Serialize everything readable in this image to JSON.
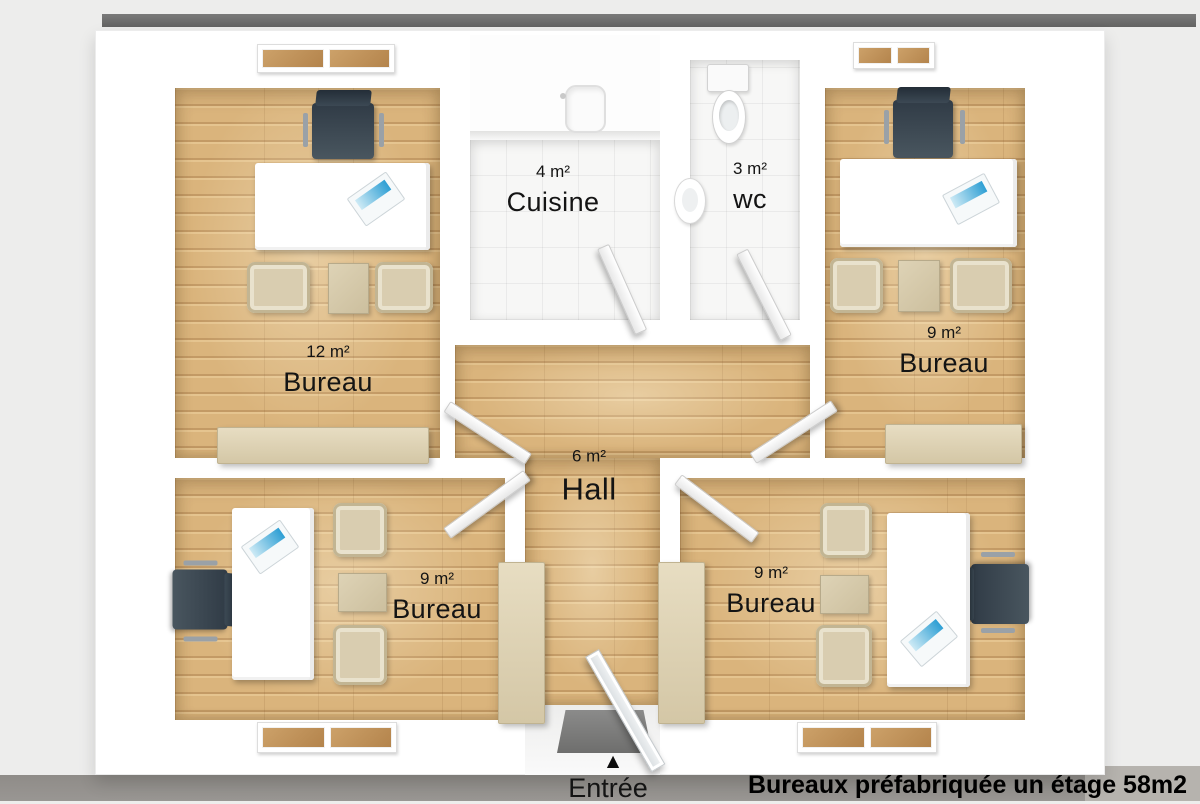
{
  "floorplan": {
    "caption": "Bureaux préfabriquée un étage 58m2",
    "entrance": {
      "label": "Entrée",
      "arrow": "▲"
    },
    "rooms": [
      {
        "name": "Bureau",
        "area": "12 m²"
      },
      {
        "name": "Cuisine",
        "area": "4 m²"
      },
      {
        "name": "wc",
        "area": "3 m²"
      },
      {
        "name": "Bureau",
        "area": "9 m²"
      },
      {
        "name": "Hall",
        "area": "6 m²"
      },
      {
        "name": "Bureau",
        "area": "9 m²"
      },
      {
        "name": "Bureau",
        "area": "9 m²"
      }
    ],
    "colors": {
      "wood": "#d9b57f",
      "wall": "#ffffff",
      "tile": "#f7f7f6",
      "office_chair": "#3c4854",
      "upholstery": "#d9cdb0",
      "ground_band": "#95928e",
      "top_bar": "#6d6d6c",
      "laptop_screen": "#2e9fd4"
    }
  }
}
